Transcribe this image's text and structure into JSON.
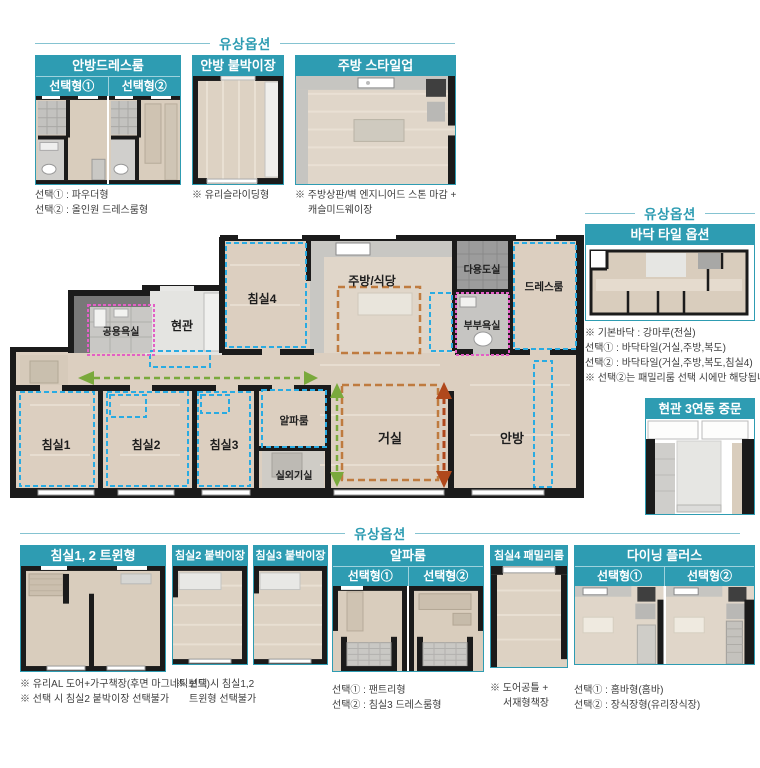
{
  "section_headers": {
    "top": "유상옵션",
    "right": "유상옵션",
    "bottom": "유상옵션"
  },
  "colors": {
    "accent_teal": "#2e9cb2",
    "option_zone_blue": "#29abe2",
    "bath_zone_pink": "#e35fc6",
    "flow_arrow_green": "#7aa93c",
    "style_zone_orange": "#bf7b3f",
    "expand_arrow_red": "#b0481c",
    "wall_black": "#1b1b1b",
    "floor_wood": "#dccfc0"
  },
  "top_options": {
    "dressroom": {
      "title": "안방드레스룸",
      "tabs": [
        "선택형①",
        "선택형②"
      ],
      "captions": [
        "선택① : 파우더형",
        "선택② : 올인원 드레스룸형"
      ]
    },
    "closet": {
      "title": "안방 붙박이장",
      "captions": [
        "※ 유리슬라이딩형"
      ]
    },
    "kitchen": {
      "title": "주방 스타일업",
      "captions": [
        "※ 주방상판/벽 엔지니어드 스톤 마감 +",
        "캐슬미드웨이장"
      ]
    }
  },
  "right_options": {
    "floor_tile": {
      "title": "바닥 타일 옵션",
      "captions": [
        "※ 기본바닥 : 강마루(전실)",
        "선택① : 바닥타일(거실,주방,복도)",
        "선택② : 바닥타일(거실,주방,복도,침실4)",
        "※ 선택②는 패밀리룸 선택 시에만 해당됩니다."
      ]
    },
    "entrance_door": {
      "title": "현관 3연동 중문"
    }
  },
  "floor_plan": {
    "rooms": {
      "bedroom1": "침실1",
      "bedroom2": "침실2",
      "bedroom3": "침실3",
      "bedroom4": "침실4",
      "alpha_room": "알파룸",
      "outdoor_unit": "실외기실",
      "living": "거실",
      "master": "안방",
      "entrance": "현관",
      "common_bath": "공용욕실",
      "kitchen_dining": "주방/식당",
      "utility": "다용도실",
      "master_bath": "부부욕실",
      "dressroom": "드레스룸"
    }
  },
  "bottom_options": {
    "twin": {
      "title": "침실1, 2 트윈형",
      "captions": [
        "※ 유리AL 도어+가구책장(후면 마그네틱보드)",
        "※ 선택 시 침실2 붙박이장 선택불가"
      ]
    },
    "closet2": {
      "title": "침실2 붙박이장",
      "captions": [
        "※ 선택 시 침실1,2",
        "트윈형 선택불가"
      ]
    },
    "closet3": {
      "title": "침실3 붙박이장"
    },
    "alpha": {
      "title": "알파룸",
      "tabs": [
        "선택형①",
        "선택형②"
      ],
      "captions": [
        "선택① : 팬트리형",
        "선택② : 침실3 드레스룸형"
      ]
    },
    "family": {
      "title": "침실4 패밀리룸",
      "captions": [
        "※ 도어공틀 +",
        "서재형책장"
      ]
    },
    "dining": {
      "title": "다이닝 플러스",
      "tabs": [
        "선택형①",
        "선택형②"
      ],
      "captions": [
        "선택① : 홈바형(홈바)",
        "선택② : 장식장형(유리장식장)"
      ]
    }
  }
}
